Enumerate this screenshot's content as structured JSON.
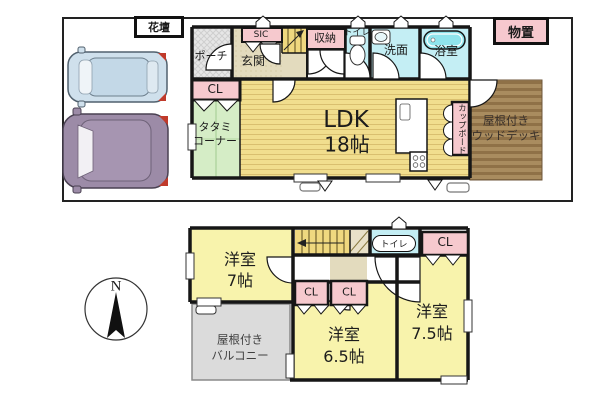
{
  "site": {
    "flower_bed": "花壇",
    "storage_shed": "物置",
    "compass_north": "N"
  },
  "floor1": {
    "porch": "ポーチ",
    "entrance": "玄関",
    "sic": "SIC",
    "storage": "収納",
    "toilet": "トイレ",
    "washroom": "洗面",
    "bathroom": "浴室",
    "closet": "CL",
    "tatami": {
      "line1": "タタミ",
      "line2": "コーナー"
    },
    "ldk": {
      "line1": "LDK",
      "line2": "18帖"
    },
    "cupboard": "カップボード",
    "wood_deck": {
      "line1": "屋根付き",
      "line2": "ウッドデッキ"
    }
  },
  "floor2": {
    "room7": {
      "line1": "洋室",
      "line2": "7帖"
    },
    "room65": {
      "line1": "洋室",
      "line2": "6.5帖"
    },
    "room75": {
      "line1": "洋室",
      "line2": "7.5帖"
    },
    "toilet": "トイレ",
    "closet_a": "CL",
    "closet_b": "CL",
    "closet_c": "CL",
    "balcony": {
      "line1": "屋根付き",
      "line2": "バルコニー"
    }
  },
  "colors": {
    "wall_black": "#161616",
    "room_yellow_1f": "#f1de8e",
    "room_yellow_2f": "#f8f3ac",
    "tatami_green": "#d5edc6",
    "wet_area_cyan": "#c4eef4",
    "bathtub_cyan": "#8fe4ec",
    "closet_pink": "#f6c9ce",
    "hall_beige": "#e3dbbe",
    "stairs_yellow": "#efd87f",
    "deck_brown": "#a3865a",
    "balcony_gray": "#dbdbdb",
    "porch_gray": "#e4e4e4",
    "car_blue": "#cfe0ec",
    "car_purple": "#9c8ba7",
    "accent_red": "#c03a2b"
  }
}
